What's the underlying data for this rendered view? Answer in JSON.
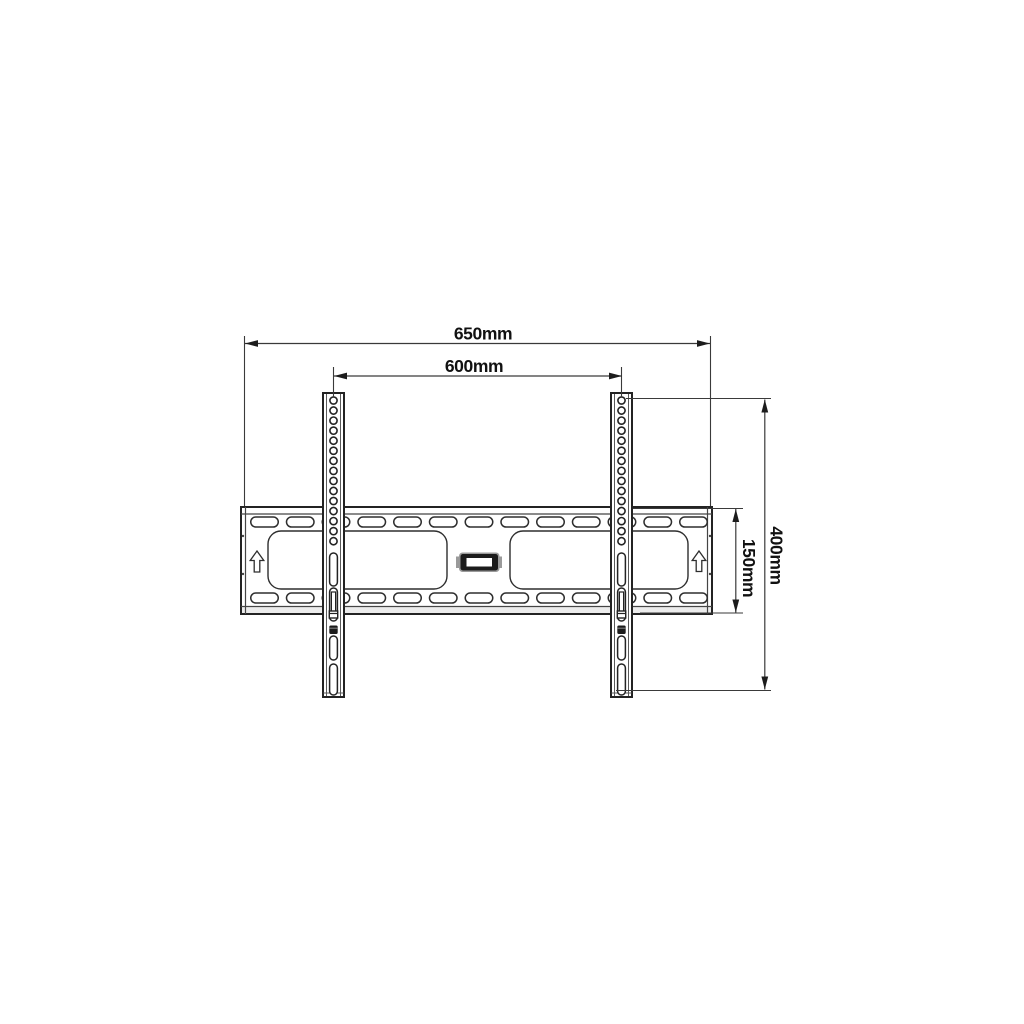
{
  "diagram": {
    "title": "Fixed TV wall mount bracket - front elevation dimension drawing",
    "type": "technical-dimension-drawing",
    "units": "mm",
    "dimensions": {
      "overall_width": {
        "label": "650mm",
        "value": 650,
        "orientation": "horizontal",
        "measures": "overall wall plate width"
      },
      "rail_spacing": {
        "label": "600mm",
        "value": 600,
        "orientation": "horizontal",
        "measures": "distance between vertical VESA rails"
      },
      "plate_height": {
        "label": "150mm",
        "value": 150,
        "orientation": "vertical",
        "measures": "wall plate height"
      },
      "rail_height": {
        "label": "400mm",
        "value": 400,
        "orientation": "vertical",
        "measures": "vertical rail height"
      }
    },
    "parts": {
      "wall_plate": {
        "slot_columns": 13,
        "slot_rows": 2,
        "large_cutouts": 2,
        "orientation_arrows": 2
      },
      "rails": {
        "count": 2,
        "holes_per_rail": 15,
        "lower_slots_per_rail": 4,
        "screws_per_rail": 2
      }
    },
    "colors": {
      "line": "#232323",
      "dim_line": "#3a3a3a",
      "screw_dark": "#1c1c1c",
      "emblem_trim": "#9a9a9a",
      "background": "#ffffff"
    }
  }
}
